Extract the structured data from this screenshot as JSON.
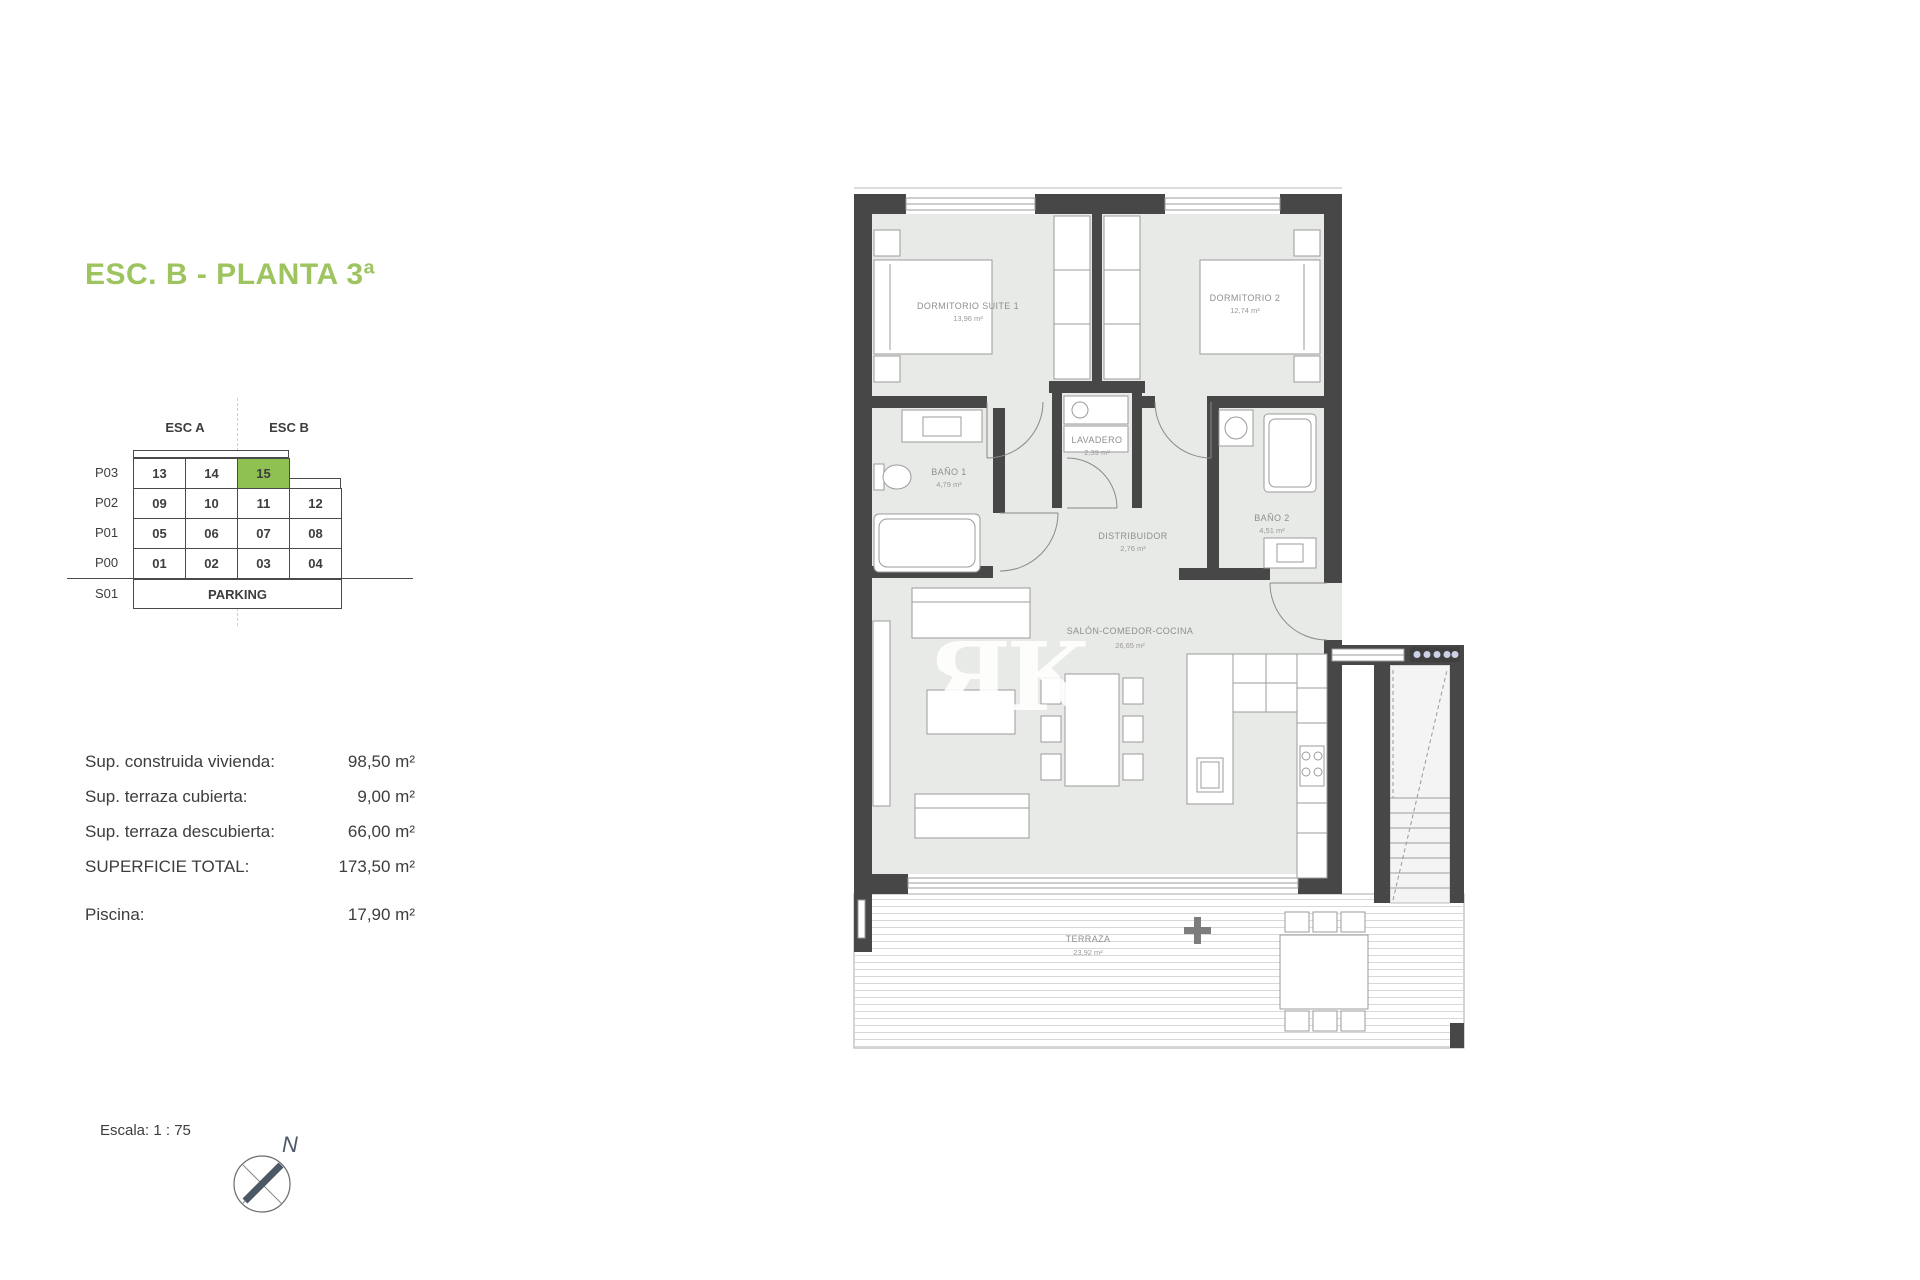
{
  "title": {
    "text": "ESC. B - PLANTA 3ª",
    "color": "#9dc45f"
  },
  "keyplan": {
    "headers": [
      {
        "label": "ESC A"
      },
      {
        "label": "ESC B"
      }
    ],
    "rows": [
      {
        "label": "P03",
        "cells": [
          "13",
          "14",
          "15"
        ]
      },
      {
        "label": "P02",
        "cells": [
          "09",
          "10",
          "11",
          "12"
        ]
      },
      {
        "label": "P01",
        "cells": [
          "05",
          "06",
          "07",
          "08"
        ]
      },
      {
        "label": "P00",
        "cells": [
          "01",
          "02",
          "03",
          "04"
        ]
      },
      {
        "label": "S01",
        "cells": [
          "PARKING"
        ]
      }
    ],
    "highlight": {
      "unit": "15",
      "color": "#8fc052"
    }
  },
  "areas": {
    "items": [
      {
        "label": "Sup. construida vivienda:",
        "value": "98,50 m²"
      },
      {
        "label": "Sup. terraza cubierta:",
        "value": "9,00 m²"
      },
      {
        "label": "Sup. terraza descubierta:",
        "value": "66,00 m²"
      },
      {
        "label": "SUPERFICIE TOTAL:",
        "value": "173,50 m²"
      },
      {
        "label": "Piscina:",
        "value": "17,90 m²"
      }
    ]
  },
  "scale": {
    "label": "Escala: 1 : 75"
  },
  "compass": {
    "n_label": "N"
  },
  "plan": {
    "wall_color": "#474747",
    "room_fill": "#e8eae7",
    "rooms": [
      {
        "name": "DORMITORIO SUITE 1",
        "area": "13,96 m²"
      },
      {
        "name": "DORMITORIO 2",
        "area": "12,74 m²"
      },
      {
        "name": "BAÑO 1",
        "area": "4,79 m²"
      },
      {
        "name": "LAVADERO",
        "area": "2,39 m²"
      },
      {
        "name": "DISTRIBUIDOR",
        "area": "2,76 m²"
      },
      {
        "name": "BAÑO 2",
        "area": "4,51 m²"
      },
      {
        "name": "SALÓN-COMEDOR-COCINA",
        "area": "26,65 m²"
      },
      {
        "name": "TERRAZA",
        "area": "23,92 m²"
      }
    ],
    "watermark": "ЯK"
  }
}
